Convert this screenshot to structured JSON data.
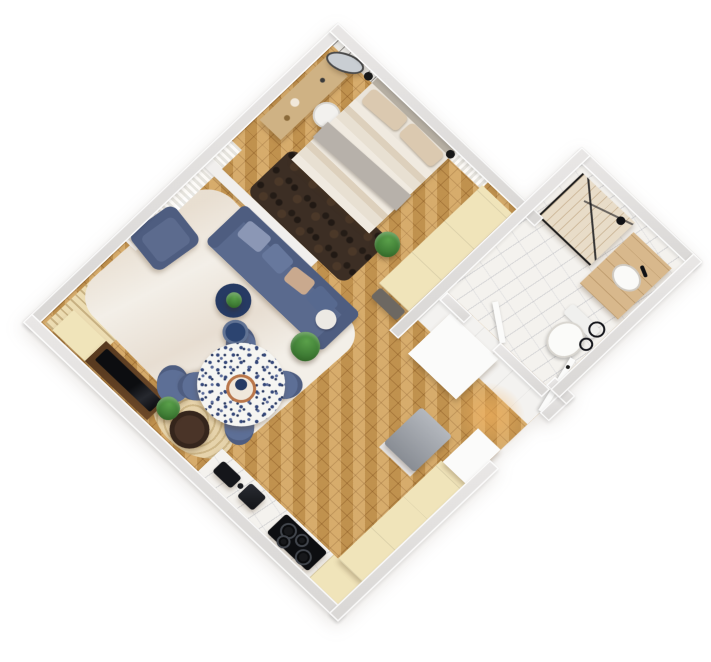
{
  "scene": {
    "kind": "3d-rendered-floor-plan",
    "view": "top-down isometric, rotated 45 degrees on white background",
    "rooms": [
      {
        "name": "bedroom",
        "items": [
          "double-bed",
          "striped-duvet",
          "pillows",
          "dark-shag-rug",
          "vanity-desk",
          "desk-chair",
          "leaning-mirror",
          "wall-lamps",
          "wardrobe",
          "foot-bench",
          "potted-plant",
          "birch-wallpaper-wall",
          "window-curtain"
        ]
      },
      {
        "name": "living-room",
        "items": [
          "blue-sofa",
          "scatter-cushions",
          "blue-armchair",
          "white-area-rug",
          "navy-nesting-tables",
          "monstera-plant",
          "tv-console",
          "tv",
          "window-curtain",
          "radiator-panel",
          "woven-round-rug",
          "dark-side-table",
          "blue-chair"
        ]
      },
      {
        "name": "dining-area",
        "items": [
          "round-terrazzo-table",
          "copper-bowl",
          "four-blue-chairs"
        ]
      },
      {
        "name": "kitchen",
        "items": [
          "marble-counter",
          "black-sink",
          "coffee-machine",
          "black-cooktop",
          "cream-cabinets",
          "tall-white-unit"
        ]
      },
      {
        "name": "hallway",
        "items": [
          "white-closet",
          "gray-bench",
          "entrance-door-open",
          "warm-door-light"
        ]
      },
      {
        "name": "bathroom",
        "items": [
          "marble-floor",
          "glass-shower",
          "shower-head",
          "wood-vanity",
          "white-basin",
          "toilet",
          "towel-rings",
          "bathroom-door-open"
        ]
      }
    ]
  },
  "palette": {
    "bg": "#ffffff",
    "wall": "#d9d7d5",
    "wood": "#cf9f58",
    "marble": "#f4f2ee",
    "whiteFloor": "#f3f2f0",
    "cream": "#f0e4ba",
    "rugLight": "#f3efe8",
    "rugDark": "#3c2e24",
    "rugWoven": "#e6d3ab",
    "sofa": "#5a6a8e",
    "sofaDark": "#4e5d80",
    "chairBlue": "#5d6f96",
    "navy": "#263a63",
    "linen": "#eae4da",
    "pillow": "#dbc9b0",
    "throwGray": "#b7b1aa",
    "walnut": "#6e4a2a",
    "dark": "#121316",
    "plant": "#3f7d35",
    "plantDark": "#2a5a1f",
    "vanityWood": "#d8b88c",
    "glow": "#f4b25e",
    "benchGray": "#9ba0a8",
    "doorWhite": "#fbfbfa",
    "terrazzo": "#f5f5f2"
  }
}
